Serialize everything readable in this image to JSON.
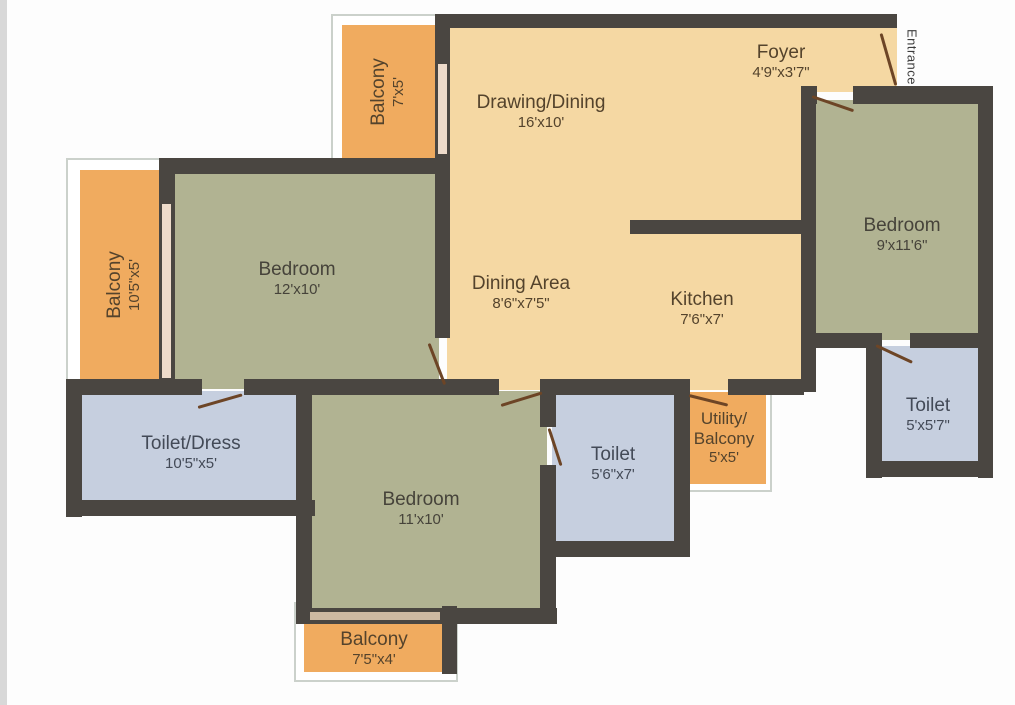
{
  "palette": {
    "balcony_orange": "#f0ab5f",
    "living_cream": "#f5d8a3",
    "bedroom_green": "#b1b392",
    "toilet_blue": "#c6cfdf",
    "wall_dark": "#4a4641",
    "door_swing_brown": "#6d4526",
    "window_frame_gray": "#cbd1cb"
  },
  "rooms": {
    "balcony_top_left": {
      "name": "Balcony",
      "dims": "7'x5'"
    },
    "drawing_dining": {
      "name": "Drawing/Dining",
      "dims": "16'x10'"
    },
    "foyer": {
      "name": "Foyer",
      "dims": "4'9\"x3'7\""
    },
    "bedroom_right": {
      "name": "Bedroom",
      "dims": "9'x11'6\""
    },
    "balcony_left": {
      "name": "Balcony",
      "dims": "10'5\"x5'"
    },
    "bedroom_left": {
      "name": "Bedroom",
      "dims": "12'x10'"
    },
    "dining_area": {
      "name": "Dining Area",
      "dims": "8'6\"x7'5\""
    },
    "kitchen": {
      "name": "Kitchen",
      "dims": "7'6\"x7'"
    },
    "toilet_dress": {
      "name": "Toilet/Dress",
      "dims": "10'5\"x5'"
    },
    "bedroom_bottom": {
      "name": "Bedroom",
      "dims": "11'x10'"
    },
    "toilet_middle": {
      "name": "Toilet",
      "dims": "5'6\"x7'"
    },
    "utility_balcony": {
      "name_line1": "Utility/",
      "name_line2": "Balcony",
      "dims": "5'x5'"
    },
    "toilet_right": {
      "name": "Toilet",
      "dims": "5'x5'7\""
    },
    "balcony_bottom": {
      "name": "Balcony",
      "dims": "7'5\"x4'"
    }
  },
  "annotations": {
    "entrance": "Entrance"
  }
}
